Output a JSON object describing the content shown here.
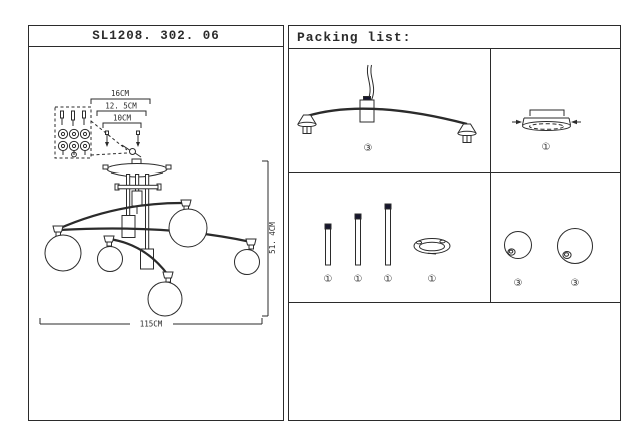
{
  "left_panel": {
    "title": "SL1208. 302. 06",
    "dim_top_outer": "16CM",
    "dim_top_middle": "12. 5CM",
    "dim_top_inner": "10CM",
    "dim_width": "115CM",
    "dim_height": "51. 4CM",
    "drawing": "six-globe-ceiling-chandelier-line-drawing",
    "detail": "wiring-terminal-block-detail"
  },
  "right_panel": {
    "header": "Packing list:",
    "cells": [
      {
        "name": "curved-arm-with-cord-and-two-lamp-holders",
        "qty": [
          "③"
        ]
      },
      {
        "name": "ceiling-canopy-plate",
        "qty": [
          "①"
        ]
      },
      {
        "name": "down-rods-short-medium-long-and-mounting-ring",
        "qty": [
          "①",
          "①",
          "①",
          "①"
        ]
      },
      {
        "name": "glass-globe-small-and-large",
        "qty": [
          "③",
          "③"
        ]
      }
    ]
  },
  "colors": {
    "line": "#2b2b2b",
    "rod_cap": "#16162e",
    "background": "#ffffff"
  }
}
